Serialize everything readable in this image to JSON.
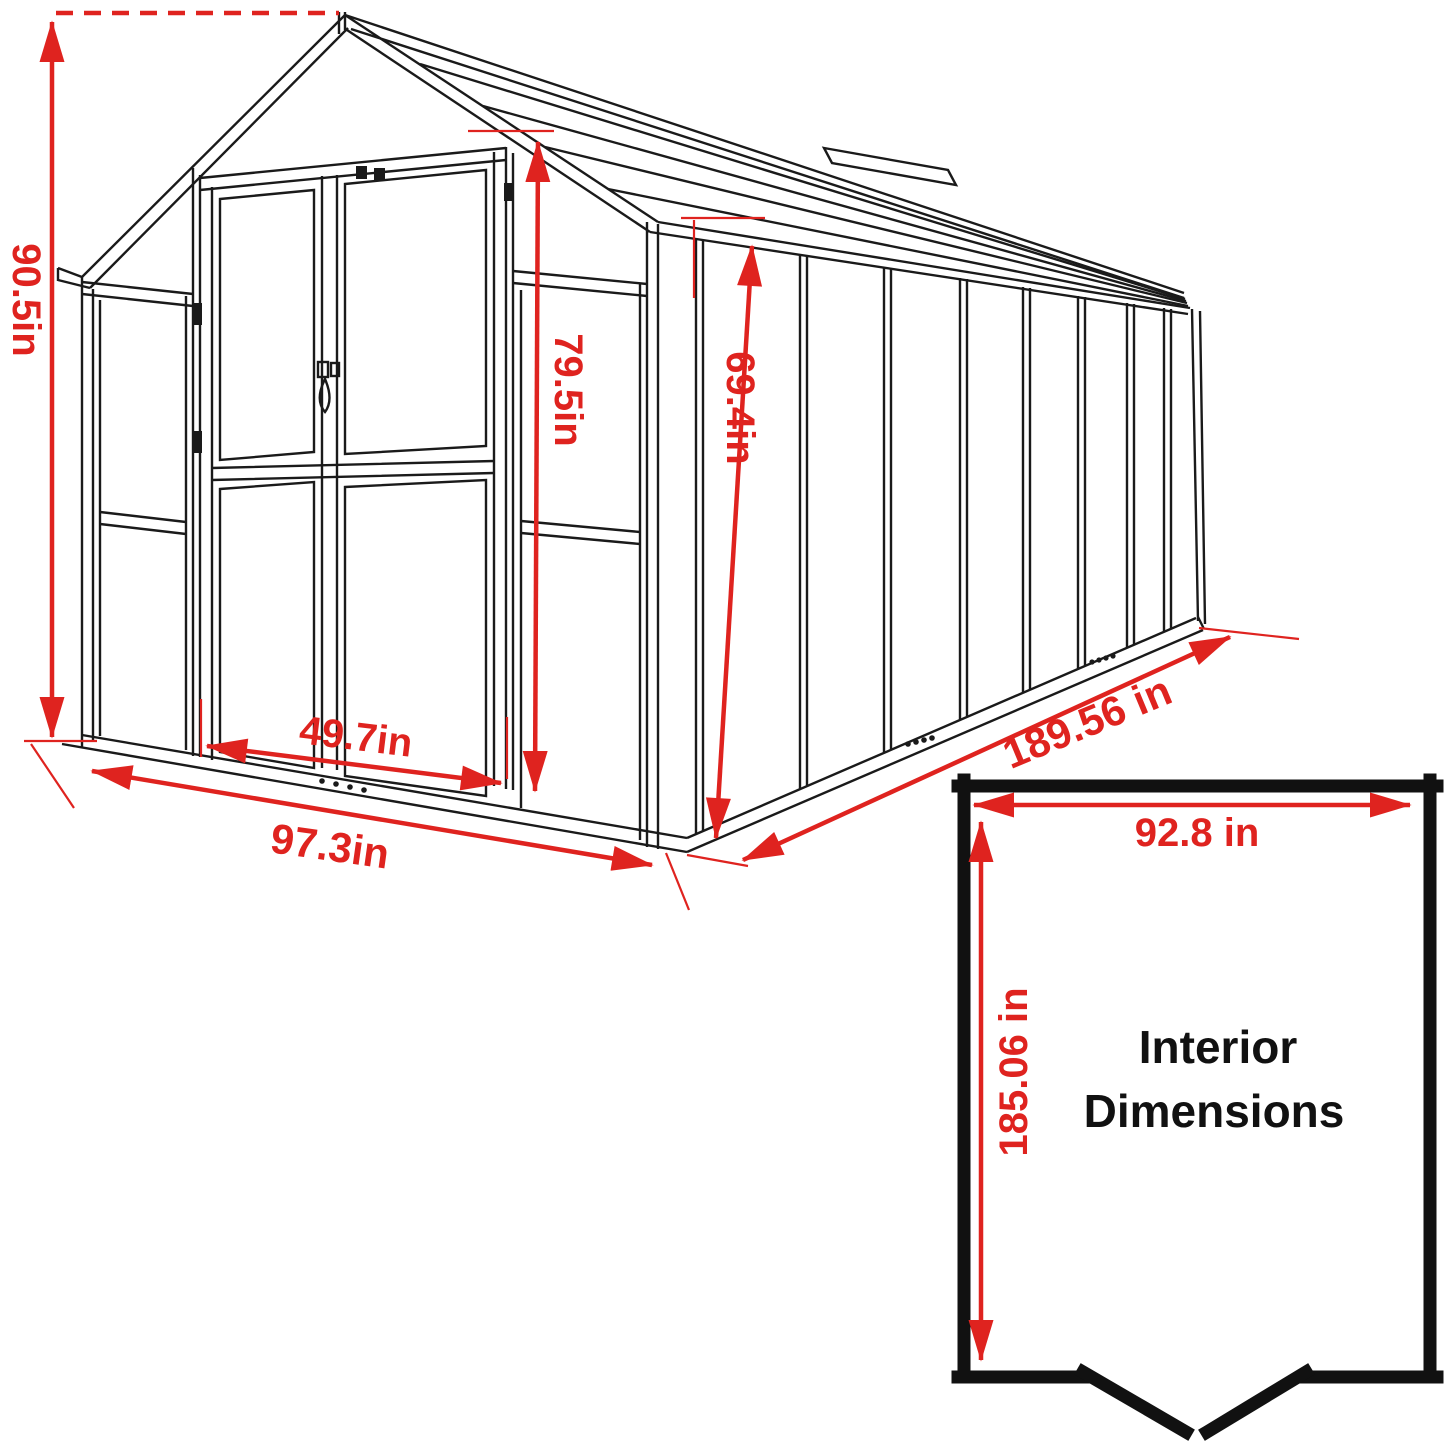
{
  "colors": {
    "dimension_red": "#df231f",
    "drawing_line": "#1a1a1a",
    "interior_border": "#111111"
  },
  "greenhouse": {
    "exterior": {
      "overall_height": "90.5in",
      "door_height": "79.5in",
      "wall_height": "69.4in",
      "door_width": "49.7in",
      "front_width": "97.3in",
      "side_length": "189.56 in"
    },
    "interior": {
      "width": "92.8 in",
      "depth": "185.06 in",
      "caption": [
        "Interior",
        "Dimensions"
      ]
    }
  }
}
